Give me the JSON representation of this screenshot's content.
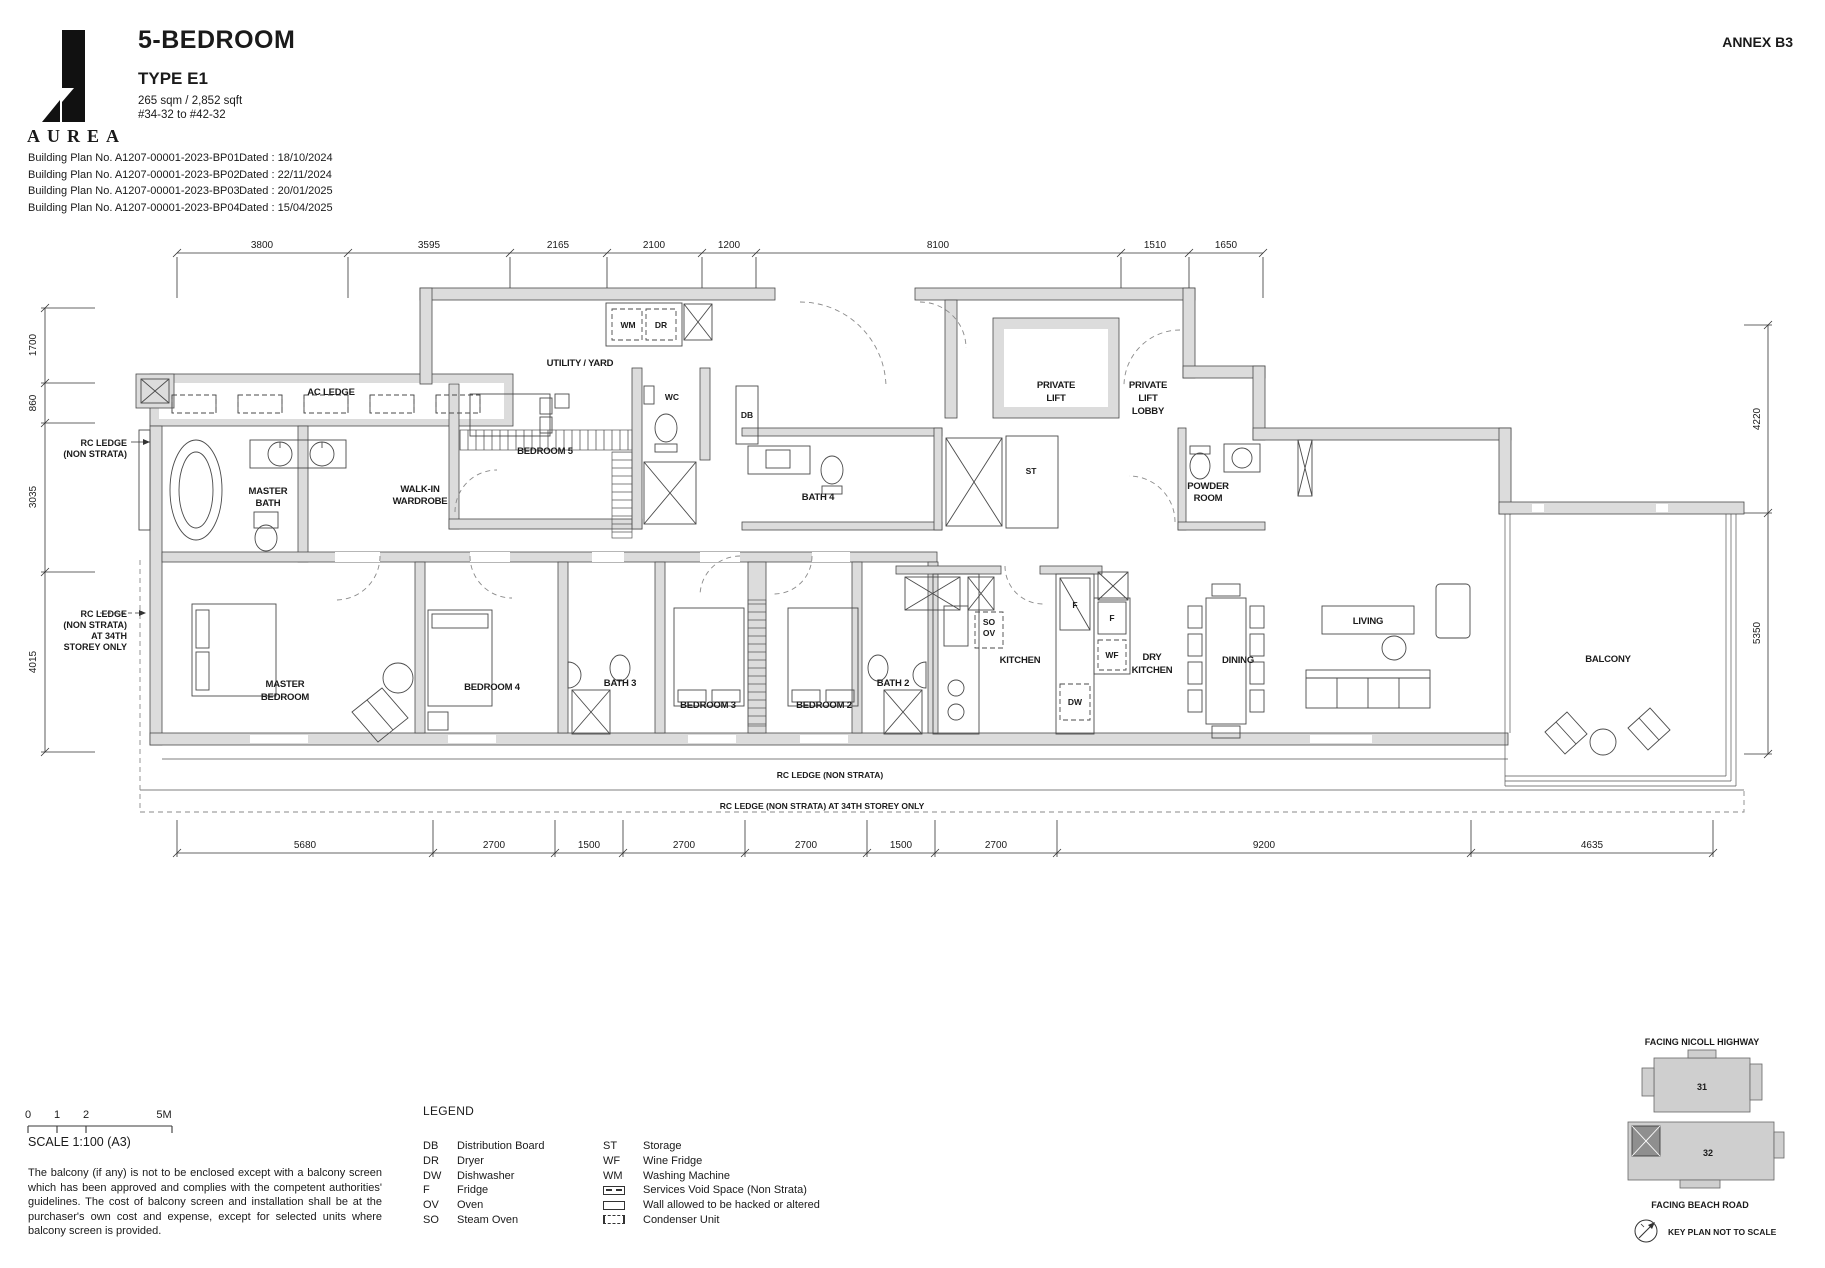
{
  "page": {
    "annex": "ANNEX B3"
  },
  "header": {
    "brand": "AUREA",
    "title": "5-BEDROOM",
    "unit_type": "TYPE E1",
    "area": "265 sqm / 2,852 sqft",
    "stack": "#34-32 to #42-32",
    "building_plans": [
      {
        "plan": "Building Plan No. A1207-00001-2023-BP01",
        "dated": "Dated : 18/10/2024"
      },
      {
        "plan": "Building Plan No. A1207-00001-2023-BP02",
        "dated": "Dated : 22/11/2024"
      },
      {
        "plan": "Building Plan No. A1207-00001-2023-BP03",
        "dated": "Dated : 20/01/2025"
      },
      {
        "plan": "Building Plan No. A1207-00001-2023-BP04",
        "dated": "Dated : 15/04/2025"
      }
    ]
  },
  "plan": {
    "dims_top": [
      "3800",
      "3595",
      "2165",
      "2100",
      "1200",
      "8100",
      "1510",
      "1650"
    ],
    "dims_bottom": [
      "5680",
      "2700",
      "1500",
      "2700",
      "2700",
      "1500",
      "2700",
      "9200",
      "4635"
    ],
    "dims_left": [
      "1700",
      "860",
      "3035",
      "4015"
    ],
    "dims_right": [
      "4220",
      "5350"
    ],
    "rooms": {
      "utility": "UTILITY / YARD",
      "bedroom5": "BEDROOM 5",
      "master_bath_1": "MASTER",
      "master_bath_2": "BATH",
      "wardrobe_1": "WALK-IN",
      "wardrobe_2": "WARDROBE",
      "master_bed_1": "MASTER",
      "master_bed_2": "BEDROOM",
      "bedroom4": "BEDROOM 4",
      "bath3": "BATH 3",
      "bedroom3": "BEDROOM 3",
      "bedroom2": "BEDROOM 2",
      "bath2": "BATH 2",
      "bath4": "BATH 4",
      "kitchen": "KITCHEN",
      "dry_kitchen_1": "DRY",
      "dry_kitchen_2": "KITCHEN",
      "dining": "DINING",
      "living": "LIVING",
      "balcony": "BALCONY",
      "private_lift_1": "PRIVATE",
      "private_lift_2": "LIFT",
      "lift_lobby_1": "PRIVATE",
      "lift_lobby_2": "LIFT",
      "lift_lobby_3": "LOBBY",
      "powder_1": "POWDER",
      "powder_2": "ROOM"
    },
    "fixtures": {
      "wm": "WM",
      "dr": "DR",
      "wc": "WC",
      "db": "DB",
      "st": "ST",
      "so": "SO",
      "ov": "OV",
      "f": "F",
      "wf": "WF",
      "dw": "DW"
    },
    "annotations": {
      "ac_ledge": "AC LEDGE",
      "rc_left_1": "RC LEDGE",
      "rc_left_2": "(NON STRATA)",
      "rc_left34_1": "RC LEDGE",
      "rc_left34_2": "(NON STRATA)",
      "rc_left34_3": "AT 34TH",
      "rc_left34_4": "STOREY ONLY",
      "rc_bottom": "RC LEDGE (NON STRATA)",
      "rc_bottom34": "RC LEDGE (NON STRATA) AT 34TH STOREY ONLY"
    }
  },
  "scalebar": {
    "t0": "0",
    "t1": "1",
    "t2": "2",
    "t5": "5M",
    "label": "SCALE 1:100 (A3)"
  },
  "disclaimer": "The balcony (if any) is not to be enclosed except with a balcony screen which has been approved and complies with the competent authorities' guidelines. The cost of balcony screen and installation shall be at the purchaser's own cost and expense, except for selected units where balcony screen is provided.",
  "legend": {
    "title": "LEGEND",
    "col1": [
      {
        "abbr": "DB",
        "label": "Distribution Board"
      },
      {
        "abbr": "DR",
        "label": "Dryer"
      },
      {
        "abbr": "DW",
        "label": "Dishwasher"
      },
      {
        "abbr": "F",
        "label": "Fridge"
      },
      {
        "abbr": "OV",
        "label": "Oven"
      },
      {
        "abbr": "SO",
        "label": "Steam Oven"
      }
    ],
    "col2": [
      {
        "abbr": "ST",
        "label": "Storage"
      },
      {
        "abbr": "WF",
        "label": "Wine Fridge"
      },
      {
        "abbr": "WM",
        "label": "Washing Machine"
      },
      {
        "abbr": "",
        "label": "Services Void Space (Non Strata)"
      },
      {
        "abbr": "",
        "label": "Wall allowed to be hacked or altered"
      },
      {
        "abbr": "",
        "label": "Condenser Unit"
      }
    ]
  },
  "keyplan": {
    "facing_top": "FACING NICOLL HIGHWAY",
    "facing_bottom": "FACING BEACH ROAD",
    "block_upper": "31",
    "block_lower": "32",
    "note": "KEY PLAN NOT TO SCALE"
  }
}
